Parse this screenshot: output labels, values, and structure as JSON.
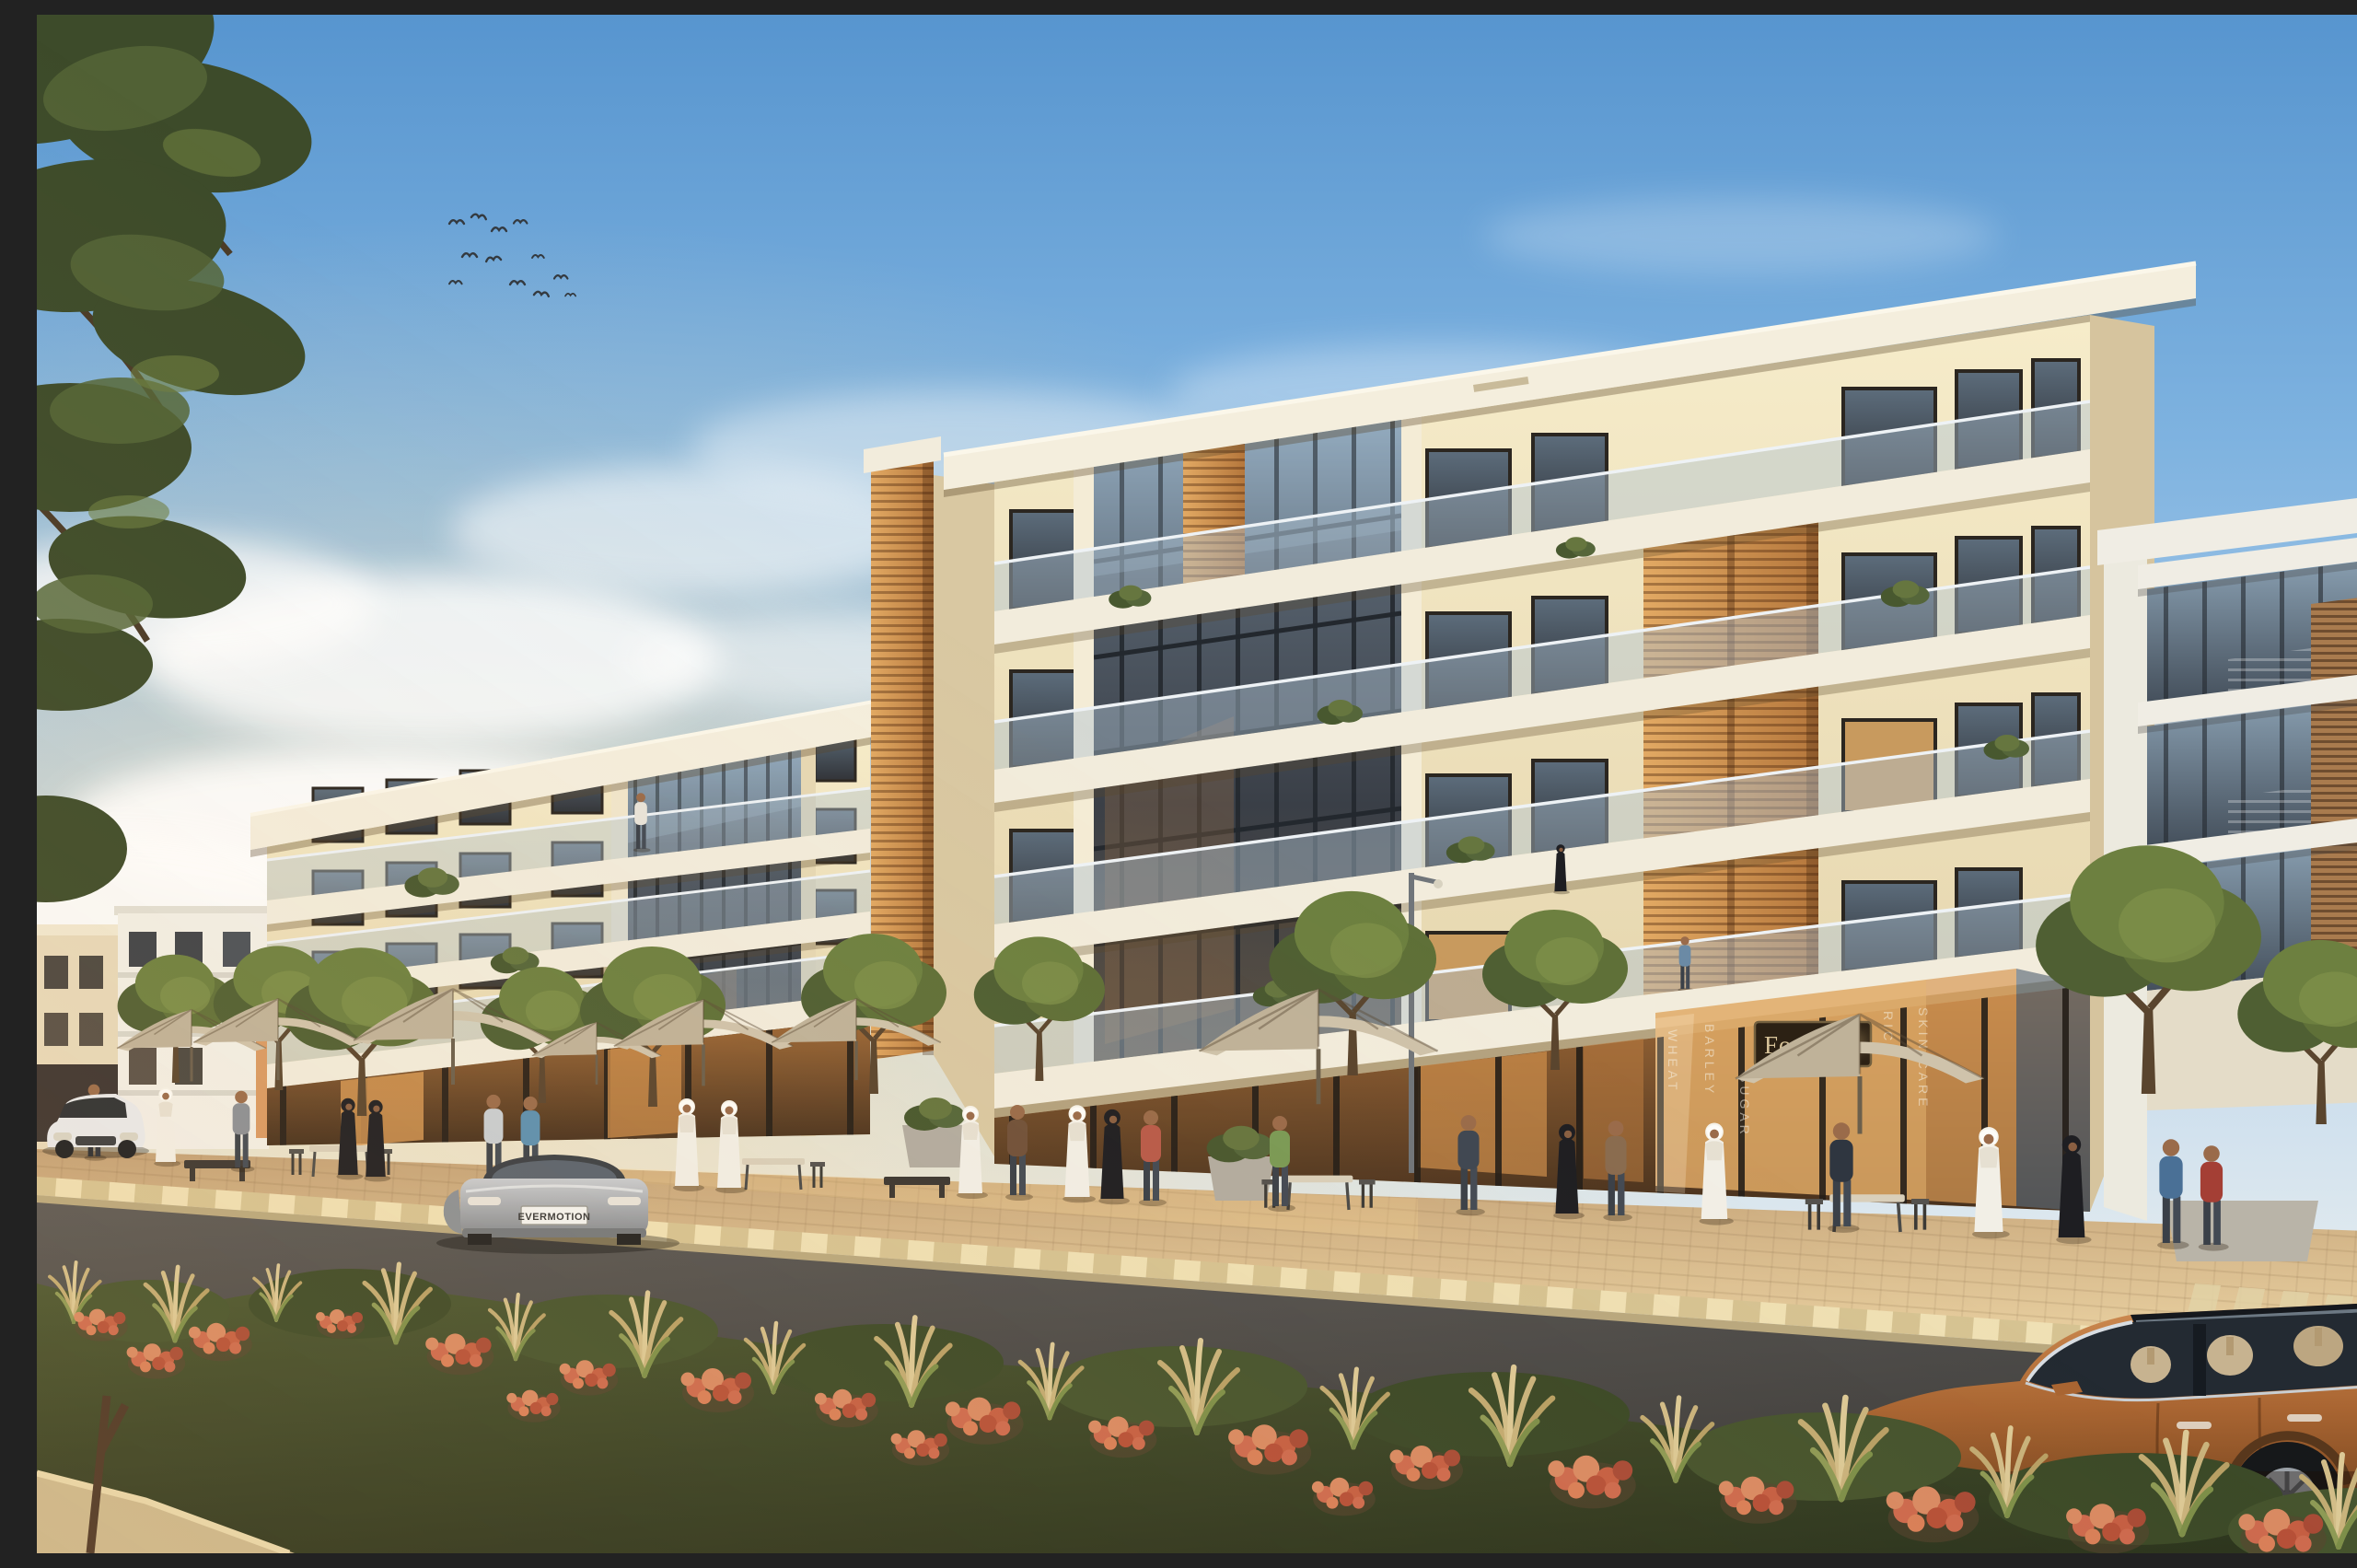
{
  "scene": {
    "description": "Golden-hour architectural rendering of modern cream mixed-use apartment blocks with ground-floor retail, cafe umbrellas, pedestrians in Emirati and casual dress, a landscaped median of coral flowers and feather grass, and three cars on the street",
    "signage": {
      "food_store_sign": "Food &"
    },
    "license_plate": "EVERMOTION",
    "storefront_window_words": [
      "WHEAT",
      "BARLEY",
      "SUGAR",
      "RICE",
      "SKIN CARE"
    ]
  },
  "palette": {
    "sky_top": "#5795cf",
    "sky_mid": "#a9c9e7",
    "sky_horizon": "#f3efe2",
    "cloud": "#ffffff",
    "facade_cream": "#ecdfbb",
    "facade_lit": "#f6ecca",
    "slab_white": "#f2ecdc",
    "glass_dark": "#3a3f47",
    "glass_sky_reflection": "#9fb6c9",
    "glass_warm_reflection": "#8a6a4a",
    "louver_orange": "#c9884a",
    "wood_louver": "#a97b4e",
    "storefront_glow": "#d89a55",
    "sidewalk": "#d9b98c",
    "curb_light": "#e9d9ae",
    "asphalt": "#4a4948",
    "lane_marking": "#d5d5d0",
    "foliage_dark": "#3d4b2a",
    "foliage_light": "#7d8f49",
    "grass_blonde": "#d2bd88",
    "flower_coral": "#cd6a4e",
    "flower_deep": "#a84b36",
    "umbrella": "#cfc3ab",
    "thobe_white": "#f2efe6",
    "abaya_black": "#1e1e22",
    "car_white": "#e9eaec",
    "car_silver": "#a8acb0",
    "car_copper": "#b0713f",
    "sign_bg": "#2c2114",
    "sign_text_color": "#d8c49a"
  },
  "inventory": {
    "buildings_visible": 3,
    "building_storeys": 5,
    "birds_count": 12,
    "umbrella_count": 8,
    "street_tree_count": 11,
    "pedestrian_count": 27,
    "cars": [
      {
        "color_name": "white",
        "position": "far left, front view"
      },
      {
        "color_name": "silver",
        "position": "centre left, rear view with EVERMOTION plate"
      },
      {
        "color_name": "copper",
        "position": "foreground right, side view"
      }
    ]
  }
}
